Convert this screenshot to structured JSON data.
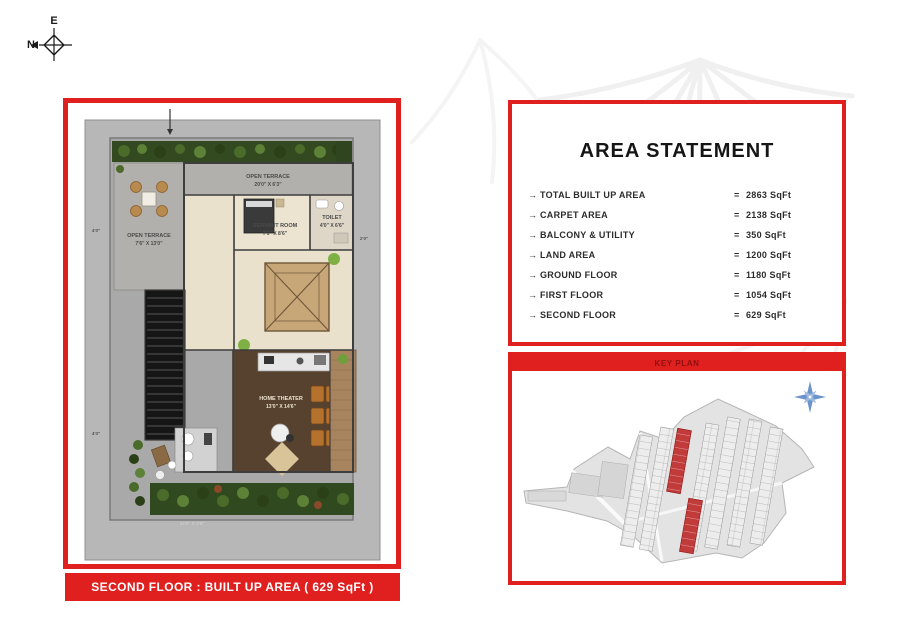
{
  "compass": {
    "east": "E",
    "north": "N"
  },
  "floor_plan": {
    "caption": "SECOND FLOOR : BUILT UP AREA ( 629 SqFt )",
    "labels": {
      "terrace_top": "OPEN TERRACE",
      "terrace_top_dim": "20'0\" X 6'3\"",
      "terrace_left": "OPEN TERRACE",
      "terrace_left_dim": "7'6\" X 13'0\"",
      "servant_room": "SERVANT ROOM",
      "servant_room_dim": "7'0\" X 8'6\"",
      "toilet": "TOILET",
      "toilet_dim": "4'0\" X 6'6\"",
      "home_theater": "HOME THEATER",
      "home_theater_dim": "13'0\" X 14'6\"",
      "dim_left_top": "4'0\"",
      "dim_left_bottom": "4'0\"",
      "dim_right": "2'0\"",
      "dim_bottom": "12'0\" X 3'6\""
    }
  },
  "area_statement": {
    "title": "AREA STATEMENT",
    "bullet": "→",
    "equals": "=",
    "rows": [
      {
        "label": "TOTAL BUILT UP AREA",
        "value": "2863 SqFt"
      },
      {
        "label": "CARPET AREA",
        "value": "2138 SqFt"
      },
      {
        "label": "BALCONY & UTILITY",
        "value": "350 SqFt"
      },
      {
        "label": "LAND AREA",
        "value": "1200 SqFt"
      },
      {
        "label": "GROUND FLOOR",
        "value": "1180 SqFt"
      },
      {
        "label": "FIRST FLOOR",
        "value": "1054 SqFt"
      },
      {
        "label": "SECOND FLOOR",
        "value": "629 SqFt"
      }
    ]
  },
  "key_plan": {
    "title": "KEY PLAN"
  },
  "colors": {
    "accent_red": "#e01f1f",
    "key_plan_title": "#8f1010",
    "map_highlight": "#c23b3b",
    "compass_blue": "#6d93cc"
  }
}
